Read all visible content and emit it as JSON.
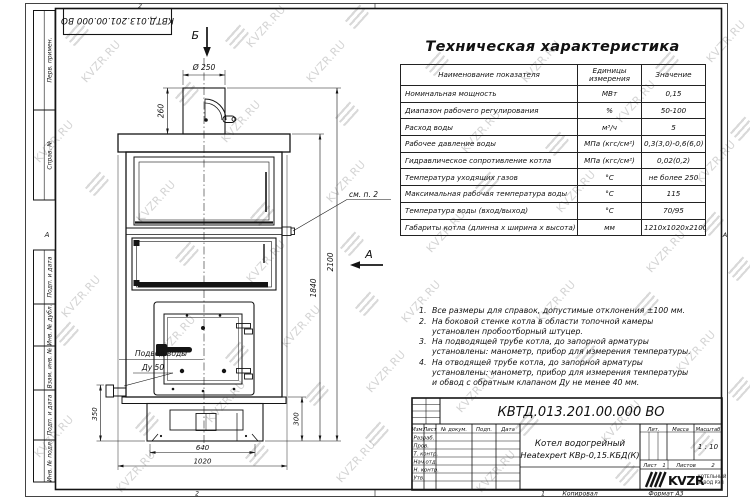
{
  "watermark": {
    "text": "KVZR.RU"
  },
  "frame": {
    "top_doc_number": "КВТД.013.201.00.000 ВО",
    "left_stamps": [
      "Перв. примен.",
      "Справ. №",
      "Подп. и дата",
      "Инв. № дубл.",
      "Взам. инв. №",
      "Подп. и дата",
      "Инв. № подл."
    ],
    "zone_top": "2",
    "zone_bottom_left": "2",
    "zone_bottom_center": "1",
    "zone_left": "А",
    "zone_right": "А",
    "copied_label": "Копировал",
    "format_label": "Формат А3"
  },
  "drawing": {
    "view_b": "Б",
    "view_a": "А",
    "see_note": "см. п. 2",
    "water_inlet_line1": "Подвод воды",
    "water_inlet_line2": "Ду 50",
    "dims": {
      "dia": "Ø 250",
      "h_chimney": "260",
      "h_total": "2100",
      "h_body": "1840",
      "h_base_right": "300",
      "h_inlet": "350",
      "w_base": "640",
      "w_total": "1020"
    }
  },
  "spec_table": {
    "title": "Техническая характеристика",
    "headers": [
      "Наименование показателя",
      "Единицы измерения",
      "Значение"
    ],
    "rows": [
      [
        "Номинальная мощность",
        "МВт",
        "0,15"
      ],
      [
        "Диапазон рабочего регулирования",
        "%",
        "50-100"
      ],
      [
        "Расход воды",
        "м³/ч",
        "5"
      ],
      [
        "Рабочее давление воды",
        "МПа (кгс/см²)",
        "0,3(3,0)-0,6(6,0)"
      ],
      [
        "Гидравлическое сопротивление котла",
        "МПа (кгс/см²)",
        "0,02(0,2)"
      ],
      [
        "Температура уходящих газов",
        "°С",
        "не более 250"
      ],
      [
        "Максимальная рабочая температура воды",
        "°С",
        "115"
      ],
      [
        "Температура воды (вход/выход)",
        "°С",
        "70/95"
      ],
      [
        "Габариты котла (длинна х ширина х высота)",
        "мм",
        "1210х1020х2100"
      ]
    ]
  },
  "notes": [
    {
      "num": "1.",
      "text": "Все размеры для справок, допустимые отклонения ±100 мм."
    },
    {
      "num": "2.",
      "text": "На боковой стенке котла в области топочной камеры установлен пробоотборный штуцер."
    },
    {
      "num": "3.",
      "text": "На подводящей трубе котла, до запорной арматуры установлены: манометр, прибор для измерения температуры."
    },
    {
      "num": "4.",
      "text": "На отводящей трубе котла, до запорной арматуры установлены: манометр, прибор для измерения температуры и обвод с обратным клапаном Ду не менее 40 мм."
    }
  ],
  "title_block": {
    "doc_number": "КВТД.013.201.00.000 ВО",
    "cols": [
      "Изм.",
      "Лист",
      "№ докум.",
      "Подп.",
      "Дата"
    ],
    "rows": [
      "Разраб.",
      "Пров.",
      "Т. контр.",
      "Нач.отд.",
      "Н. контр.",
      "Утв."
    ],
    "product_line1": "Котел водогрейный",
    "product_line2": "Heatexpert КВр-0,15.КБД(К)",
    "lit": "Лит.",
    "mass": "Масса",
    "scale": "Масштаб",
    "scale_value": "1 : 10",
    "sheet": "Лист",
    "sheet_no": "1",
    "sheets": "Листов",
    "sheets_no": "2",
    "logo": "KVZR",
    "logo_sub1": "КОТЕЛЬНЫЙ",
    "logo_sub2": "ЗАВОД РЭП"
  }
}
